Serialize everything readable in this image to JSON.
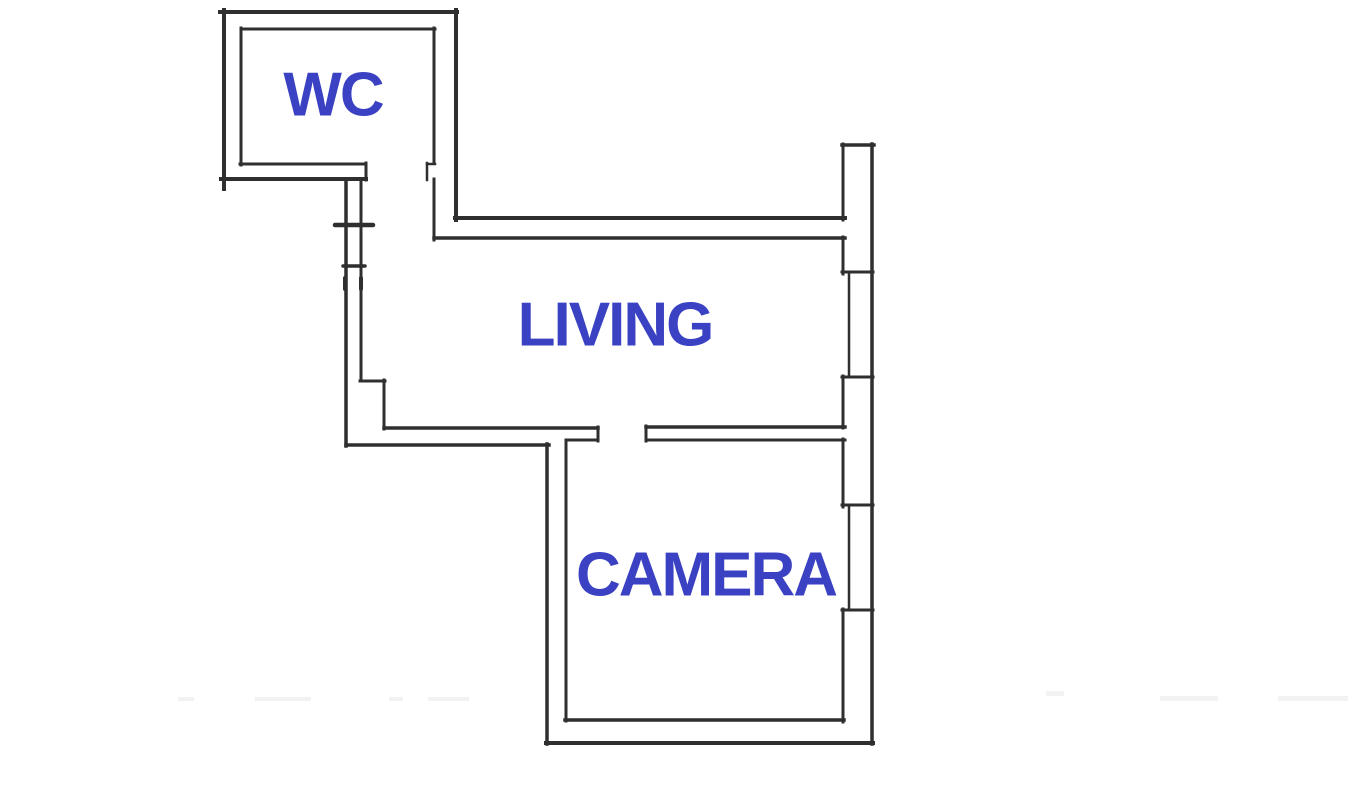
{
  "floorplan": {
    "canvas": {
      "width": 1353,
      "height": 798
    },
    "colors": {
      "background": "#ffffff",
      "wall": "#2f2f2f",
      "label": "#3a42c3",
      "artifact": "#f2f2f2"
    },
    "rooms": [
      {
        "id": "wc",
        "label": "WC",
        "cx": 333,
        "cy": 98
      },
      {
        "id": "living",
        "label": "LIVING",
        "cx": 615,
        "cy": 328
      },
      {
        "id": "camera",
        "label": "CAMERA",
        "cx": 706,
        "cy": 578
      }
    ],
    "walls": [
      {
        "name": "wc-wall-top-outer",
        "x1": 220,
        "y1": 12,
        "x2": 457,
        "y2": 12,
        "w": 4
      },
      {
        "name": "wc-wall-top-inner",
        "x1": 241,
        "y1": 29,
        "x2": 435,
        "y2": 29,
        "w": 3
      },
      {
        "name": "wc-wall-left-outer",
        "x1": 224,
        "y1": 10,
        "x2": 224,
        "y2": 189,
        "w": 4
      },
      {
        "name": "wc-wall-left-inner",
        "x1": 241,
        "y1": 28,
        "x2": 241,
        "y2": 165,
        "w": 3
      },
      {
        "name": "wc-wall-bottom-inner",
        "x1": 240,
        "y1": 164,
        "x2": 366,
        "y2": 164,
        "w": 3
      },
      {
        "name": "wc-wall-bottom-outer",
        "x1": 221,
        "y1": 179,
        "x2": 366,
        "y2": 179,
        "w": 4
      },
      {
        "name": "wc-door-left-jamb",
        "x1": 366,
        "y1": 163,
        "x2": 366,
        "y2": 180,
        "w": 3
      },
      {
        "name": "wc-wall-right-outer",
        "x1": 456,
        "y1": 10,
        "x2": 456,
        "y2": 220,
        "w": 4
      },
      {
        "name": "wc-wall-right-inner-upper",
        "x1": 434,
        "y1": 28,
        "x2": 434,
        "y2": 163,
        "w": 3
      },
      {
        "name": "wc-door-right-jamb-top",
        "x1": 427,
        "y1": 164,
        "x2": 435,
        "y2": 164,
        "w": 2.5
      },
      {
        "name": "wc-door-right-jamb-side",
        "x1": 427,
        "y1": 163,
        "x2": 427,
        "y2": 180,
        "w": 2.5
      },
      {
        "name": "wc-wall-right-inner-lower",
        "x1": 434,
        "y1": 179,
        "x2": 434,
        "y2": 240,
        "w": 3
      },
      {
        "name": "living-wall-top-outer",
        "x1": 455,
        "y1": 218,
        "x2": 845,
        "y2": 218,
        "w": 4
      },
      {
        "name": "living-wall-top-inner",
        "x1": 434,
        "y1": 238,
        "x2": 845,
        "y2": 238,
        "w": 3.5
      },
      {
        "name": "right-wall-top-cap",
        "x1": 842,
        "y1": 145,
        "x2": 874,
        "y2": 145,
        "w": 3.5
      },
      {
        "name": "right-wall-outer",
        "x1": 872,
        "y1": 144,
        "x2": 872,
        "y2": 744,
        "w": 3.5
      },
      {
        "name": "right-wall-inner-1",
        "x1": 843,
        "y1": 144,
        "x2": 843,
        "y2": 220,
        "w": 3
      },
      {
        "name": "right-wall-inner-2",
        "x1": 843,
        "y1": 237,
        "x2": 843,
        "y2": 274,
        "w": 3
      },
      {
        "name": "window-1-top-cap",
        "x1": 842,
        "y1": 272,
        "x2": 873,
        "y2": 272,
        "w": 3
      },
      {
        "name": "window-1-glass",
        "x1": 849,
        "y1": 272,
        "x2": 849,
        "y2": 377,
        "w": 2.5
      },
      {
        "name": "window-1-bottom-cap",
        "x1": 842,
        "y1": 377,
        "x2": 873,
        "y2": 377,
        "w": 3
      },
      {
        "name": "right-wall-inner-3",
        "x1": 843,
        "y1": 376,
        "x2": 843,
        "y2": 428,
        "w": 3
      },
      {
        "name": "divider-wall-top",
        "x1": 646,
        "y1": 427,
        "x2": 845,
        "y2": 427,
        "w": 3.5
      },
      {
        "name": "divider-wall-bottom",
        "x1": 646,
        "y1": 440,
        "x2": 845,
        "y2": 440,
        "w": 3
      },
      {
        "name": "divider-wall-end-cap",
        "x1": 646,
        "y1": 426,
        "x2": 646,
        "y2": 441,
        "w": 3
      },
      {
        "name": "right-wall-inner-4",
        "x1": 843,
        "y1": 439,
        "x2": 843,
        "y2": 507,
        "w": 3
      },
      {
        "name": "window-2-top-cap",
        "x1": 842,
        "y1": 505,
        "x2": 873,
        "y2": 505,
        "w": 3
      },
      {
        "name": "window-2-glass",
        "x1": 849,
        "y1": 505,
        "x2": 849,
        "y2": 610,
        "w": 2.5
      },
      {
        "name": "window-2-bottom-cap",
        "x1": 842,
        "y1": 610,
        "x2": 873,
        "y2": 610,
        "w": 3
      },
      {
        "name": "right-wall-inner-5",
        "x1": 843,
        "y1": 609,
        "x2": 843,
        "y2": 722,
        "w": 3
      },
      {
        "name": "hall-wall-left-outer",
        "x1": 346,
        "y1": 180,
        "x2": 346,
        "y2": 446,
        "w": 3.5
      },
      {
        "name": "hall-wall-left-inner",
        "x1": 361,
        "y1": 180,
        "x2": 361,
        "y2": 381,
        "w": 3
      },
      {
        "name": "entrance-door-tick-upper",
        "x1": 335,
        "y1": 225,
        "x2": 373,
        "y2": 225,
        "w": 4.5
      },
      {
        "name": "entrance-door-tick-lower",
        "x1": 343,
        "y1": 266,
        "x2": 365,
        "y2": 266,
        "w": 3.5
      },
      {
        "name": "entrance-jamb-mark-left",
        "x1": 345,
        "y1": 278,
        "x2": 345,
        "y2": 289,
        "w": 4
      },
      {
        "name": "entrance-jamb-mark-right",
        "x1": 361,
        "y1": 278,
        "x2": 361,
        "y2": 289,
        "w": 4
      },
      {
        "name": "living-step-horizontal",
        "x1": 360,
        "y1": 381,
        "x2": 385,
        "y2": 381,
        "w": 3
      },
      {
        "name": "living-step-vertical",
        "x1": 384,
        "y1": 380,
        "x2": 384,
        "y2": 429,
        "w": 3
      },
      {
        "name": "living-wall-bottom-inner",
        "x1": 384,
        "y1": 428,
        "x2": 598,
        "y2": 428,
        "w": 3.5
      },
      {
        "name": "camera-door-jamb-bottom",
        "x1": 566,
        "y1": 440,
        "x2": 598,
        "y2": 440,
        "w": 3
      },
      {
        "name": "camera-door-jamb-cap",
        "x1": 598,
        "y1": 427,
        "x2": 598,
        "y2": 441,
        "w": 3
      },
      {
        "name": "living-wall-bottom-outer",
        "x1": 346,
        "y1": 445,
        "x2": 549,
        "y2": 445,
        "w": 3.5
      },
      {
        "name": "camera-wall-left-outer",
        "x1": 547,
        "y1": 444,
        "x2": 547,
        "y2": 744,
        "w": 3.5
      },
      {
        "name": "camera-wall-left-inner",
        "x1": 566,
        "y1": 440,
        "x2": 566,
        "y2": 721,
        "w": 3
      },
      {
        "name": "camera-wall-bottom-inner",
        "x1": 565,
        "y1": 720,
        "x2": 844,
        "y2": 720,
        "w": 3.5
      },
      {
        "name": "camera-wall-bottom-outer",
        "x1": 546,
        "y1": 743,
        "x2": 873,
        "y2": 743,
        "w": 4
      }
    ],
    "artifacts": [
      {
        "x": 178,
        "y": 697,
        "wd": 16,
        "ht": 4
      },
      {
        "x": 255,
        "y": 697,
        "wd": 56,
        "ht": 4
      },
      {
        "x": 389,
        "y": 697,
        "wd": 14,
        "ht": 4
      },
      {
        "x": 428,
        "y": 697,
        "wd": 41,
        "ht": 4
      },
      {
        "x": 1046,
        "y": 691,
        "wd": 18,
        "ht": 5
      },
      {
        "x": 1160,
        "y": 696,
        "wd": 58,
        "ht": 5
      },
      {
        "x": 1278,
        "y": 696,
        "wd": 70,
        "ht": 5
      }
    ]
  }
}
